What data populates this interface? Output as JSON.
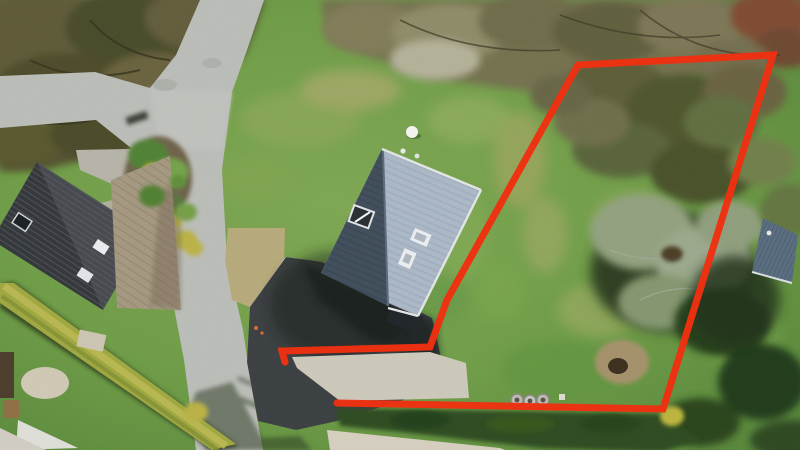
{
  "scene": {
    "type": "aerial-drone-photo",
    "subject": "residential plot with detached house, driveway, gardens, roads and a red property-boundary overlay drawn on the lawn parcel",
    "canvas": {
      "width": 800,
      "height": 450
    }
  },
  "boundary": {
    "color": "#ee2d0f",
    "stroke_width": 7,
    "points": "285,362 282,351 430,347 447,300 578,65 773,55 663,409 337,403",
    "shape": "open polygon with gap at driveway entrance between (337,403) and (282,351)"
  },
  "palette": {
    "grass_base": "#6e9a48",
    "grass_light": "#8aa75c",
    "grass_dark": "#4e7c36",
    "meadow": "#679446",
    "dry_grass": "#a5a36b",
    "dry_patch": "#b3a678",
    "trees_olive": "#55532f",
    "brush": "#7d7a5a",
    "brush_red": "#7a4a32",
    "scrub_pale": "#93a083",
    "road": "#b7b9b5",
    "asphalt": "#3a3e41",
    "deep_shadow": "#1c2418",
    "roof_light": "#a7b4c4",
    "roof_dark": "#3f4b59",
    "neighbor_roof": "#44474c",
    "neighbor_roof_dark": "#33363a",
    "deck_wood": "#a1937d",
    "cobble": "#b3afa5",
    "hedge_yellow": "#9aa33f",
    "hedge_highlight": "#b9b652",
    "hedge_dark": "#2e4a22",
    "gravel": "#c9c5b8",
    "sand": "#d3ccbd",
    "stone_circle": "#cdc5b2",
    "tarp": "#dcdcd6",
    "shed_roof": "#57697c",
    "white_trim": "#e9ecef",
    "dirt_mound": "#a08c67",
    "ring_concrete": "#b9b7ae"
  }
}
